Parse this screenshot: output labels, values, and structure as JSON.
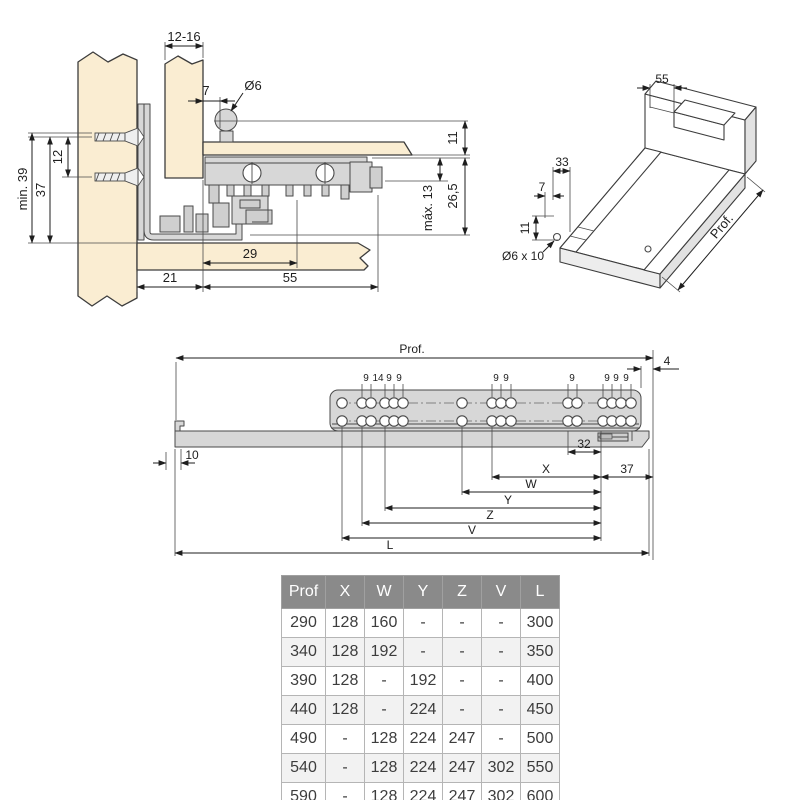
{
  "colors": {
    "wood": "#FAEDD2",
    "metal": "#D7D7D7",
    "line": "#3C3C3C",
    "dimension": "#1E1E1E",
    "table_header_bg": "#8A8A8A",
    "table_header_text": "#FFFFFF",
    "table_row_alt": "#F2F2F2"
  },
  "cross_section": {
    "dims": {
      "front_thickness": "12-16",
      "pin_offset": "7",
      "pin_diameter": "Ø6",
      "screw_spacing": "12",
      "screw_height": "37",
      "min_height": "min. 39",
      "bottom_thickness": "11",
      "max_clearance": "máx. 13",
      "slide_height": "26,5",
      "hook_offset": "29",
      "back_offset": "21",
      "slide_depth": "55"
    }
  },
  "iso_view": {
    "dims": {
      "notch_width": "55",
      "notch_length": "33",
      "notch_offset": "7",
      "front_height": "11",
      "hole_spec": "Ø6 x 10",
      "depth": "Prof."
    }
  },
  "side_view": {
    "dims": {
      "depth": "Prof.",
      "front_gap": "4",
      "front_offset": "10",
      "rear_pitch": "32",
      "rear_offset": "37",
      "x": "X",
      "w": "W",
      "y": "Y",
      "z": "Z",
      "v": "V",
      "l": "L"
    },
    "hole_pitch": [
      "9",
      "14",
      "9",
      "9",
      "9",
      "9",
      "9",
      "9",
      "9",
      "9"
    ]
  },
  "table": {
    "headers": [
      "Prof",
      "X",
      "W",
      "Y",
      "Z",
      "V",
      "L"
    ],
    "rows": [
      [
        "290",
        "128",
        "160",
        "-",
        "-",
        "-",
        "300"
      ],
      [
        "340",
        "128",
        "192",
        "-",
        "-",
        "-",
        "350"
      ],
      [
        "390",
        "128",
        "-",
        "192",
        "-",
        "-",
        "400"
      ],
      [
        "440",
        "128",
        "-",
        "224",
        "-",
        "-",
        "450"
      ],
      [
        "490",
        "-",
        "128",
        "224",
        "247",
        "-",
        "500"
      ],
      [
        "540",
        "-",
        "128",
        "224",
        "247",
        "302",
        "550"
      ],
      [
        "590",
        "-",
        "128",
        "224",
        "247",
        "302",
        "600"
      ]
    ]
  }
}
